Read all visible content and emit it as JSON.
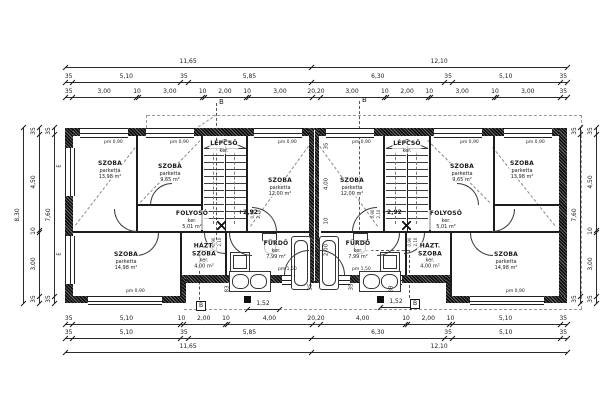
{
  "colors": {
    "ink": "#1a1a1a",
    "wall_hatch": "#0e0e0e",
    "dash": "#999999",
    "section_dash": "#555555",
    "bg": "#ffffff"
  },
  "rooms": [
    {
      "name": "SZOBA",
      "finish": "parketta",
      "area": "13,98 m²",
      "x": 110,
      "y": 170
    },
    {
      "name": "SZOBA",
      "finish": "parketta",
      "area": "9,65 m²",
      "x": 170,
      "y": 173
    },
    {
      "name": "LÉPCSŐ",
      "finish": "ker.",
      "area": "",
      "x": 224,
      "y": 147
    },
    {
      "name": "SZOBA",
      "finish": "parketta",
      "area": "12,00 m²",
      "x": 280,
      "y": 187
    },
    {
      "name": "FOLYOSÓ",
      "finish": "ker.",
      "area": "5,01 m²",
      "x": 192,
      "y": 220
    },
    {
      "name": "SZOBA",
      "finish": "parketta",
      "area": "14,98 m²",
      "x": 126,
      "y": 261
    },
    {
      "name": "HÁZT. SZOBA",
      "finish": "ker.",
      "area": "4,00 m²",
      "x": 204,
      "y": 256
    },
    {
      "name": "FÜRDŐ",
      "finish": "ker.",
      "area": "7,99 m²",
      "x": 276,
      "y": 250
    },
    {
      "name": "SZOBA",
      "finish": "parketta",
      "area": "12,00 m²",
      "x": 352,
      "y": 187
    },
    {
      "name": "LÉPCSŐ",
      "finish": "ker.",
      "area": "",
      "x": 407,
      "y": 147
    },
    {
      "name": "SZOBA",
      "finish": "parketta",
      "area": "9,65 m²",
      "x": 462,
      "y": 173
    },
    {
      "name": "SZOBA",
      "finish": "parketta",
      "area": "13,98 m²",
      "x": 522,
      "y": 170
    },
    {
      "name": "FOLYOSÓ",
      "finish": "ker.",
      "area": "5,01 m²",
      "x": 446,
      "y": 220
    },
    {
      "name": "FÜRDŐ",
      "finish": "ker.",
      "area": "7,99 m²",
      "x": 358,
      "y": 250
    },
    {
      "name": "HÁZT. SZOBA",
      "finish": "ker.",
      "area": "4,00 m²",
      "x": 430,
      "y": 256
    },
    {
      "name": "SZOBA",
      "finish": "parketta",
      "area": "14,98 m²",
      "x": 506,
      "y": 261
    }
  ],
  "dim_chains": [
    {
      "id": "top-total",
      "orient": "h",
      "x1": 65,
      "x2": 567,
      "pos": 59,
      "values": [
        "11,65",
        "12,10"
      ]
    },
    {
      "id": "top-main",
      "orient": "h",
      "x1": 65,
      "x2": 567,
      "pos": 74,
      "values": [
        "35",
        "5,10",
        "35",
        "5,85",
        "6,30",
        "35",
        "5,10",
        "35"
      ]
    },
    {
      "id": "top-detail",
      "orient": "h",
      "x1": 65,
      "x2": 567,
      "pos": 89,
      "values": [
        "35",
        "3,00",
        "10",
        "3,00",
        "10",
        "2,00",
        "10",
        "3,00",
        "20,20",
        "3,00",
        "10",
        "2,00",
        "10",
        "3,00",
        "10",
        "3,00",
        "35"
      ]
    },
    {
      "id": "bottom-detail",
      "orient": "h",
      "x1": 65,
      "x2": 567,
      "pos": 316,
      "values": [
        "35",
        "5,10",
        "10",
        "2,00",
        "10",
        "4,00",
        "20,20",
        "4,00",
        "10",
        "2,00",
        "10",
        "5,10",
        "35"
      ]
    },
    {
      "id": "bottom-main",
      "orient": "h",
      "x1": 65,
      "x2": 567,
      "pos": 330,
      "values": [
        "35",
        "5,10",
        "35",
        "5,85",
        "6,30",
        "35",
        "5,10",
        "35"
      ]
    },
    {
      "id": "bottom-total",
      "orient": "h",
      "x1": 65,
      "x2": 567,
      "pos": 344,
      "values": [
        "11,65",
        "12,10"
      ]
    },
    {
      "id": "terrace-left",
      "orient": "h",
      "x1": 247,
      "x2": 279,
      "pos": 301,
      "values": [
        "1,52"
      ]
    },
    {
      "id": "terrace-right",
      "orient": "h",
      "x1": 380,
      "x2": 412,
      "pos": 299,
      "values": [
        "1,52"
      ]
    },
    {
      "id": "left-total",
      "orient": "v",
      "y1": 127,
      "y2": 303,
      "pos": 14,
      "values": [
        "8,30"
      ]
    },
    {
      "id": "left-main",
      "orient": "v",
      "y1": 127,
      "y2": 303,
      "pos": 30,
      "values": [
        "35",
        "4,50",
        "10",
        "3,00",
        "35"
      ]
    },
    {
      "id": "left-inner",
      "orient": "v",
      "y1": 127,
      "y2": 303,
      "pos": 45,
      "values": [
        "35",
        "7,60",
        "35"
      ]
    },
    {
      "id": "right-inner",
      "orient": "v",
      "y1": 127,
      "y2": 303,
      "pos": 571,
      "values": [
        "35",
        "7,60",
        "35"
      ]
    },
    {
      "id": "right-outer",
      "orient": "v",
      "y1": 127,
      "y2": 303,
      "pos": 587,
      "values": [
        "35",
        "4,50",
        "10",
        "3,00",
        "35"
      ]
    }
  ],
  "float_labels": [
    {
      "text": "+2,92",
      "x": 238,
      "y": 210,
      "size": 6,
      "bold": true
    },
    {
      "text": "+2,92",
      "x": 382,
      "y": 210,
      "size": 6,
      "bold": true
    },
    {
      "text": "B",
      "x": 219,
      "y": 99,
      "size": 7
    },
    {
      "text": "B",
      "x": 362,
      "y": 97,
      "size": 7
    },
    {
      "text": "B",
      "x": 196,
      "y": 301,
      "size": 6,
      "boxed": true
    },
    {
      "text": "B",
      "x": 410,
      "y": 299,
      "size": 6,
      "boxed": true
    },
    {
      "text": "E",
      "x": 60,
      "y": 166,
      "size": 5,
      "rot": -90
    },
    {
      "text": "E",
      "x": 60,
      "y": 254,
      "size": 5,
      "rot": -90
    },
    {
      "text": "35",
      "x": 327,
      "y": 146,
      "size": 5.5,
      "rot": -90
    },
    {
      "text": "4,00",
      "x": 327,
      "y": 184,
      "size": 5.5,
      "rot": -90
    },
    {
      "text": "10",
      "x": 327,
      "y": 221,
      "size": 5.5,
      "rot": -90
    },
    {
      "text": "2,00",
      "x": 327,
      "y": 250,
      "size": 5.5,
      "rot": -90
    },
    {
      "text": "35",
      "x": 311,
      "y": 287,
      "size": 5.5,
      "rot": -90
    },
    {
      "text": "35",
      "x": 352,
      "y": 287,
      "size": 5.5,
      "rot": -90
    },
    {
      "text": "83",
      "x": 228,
      "y": 289,
      "size": 5.5,
      "rot": -90
    },
    {
      "text": "83",
      "x": 392,
      "y": 289,
      "size": 5.5,
      "rot": -90
    },
    {
      "text": "pm 0,90",
      "x": 104,
      "y": 141,
      "size": 4.5
    },
    {
      "text": "pm 0,90",
      "x": 170,
      "y": 141,
      "size": 4.5
    },
    {
      "text": "pm 0,90",
      "x": 278,
      "y": 141,
      "size": 4.5
    },
    {
      "text": "pm 0,90",
      "x": 352,
      "y": 141,
      "size": 4.5
    },
    {
      "text": "pm 0,90",
      "x": 460,
      "y": 141,
      "size": 4.5
    },
    {
      "text": "pm 0,90",
      "x": 526,
      "y": 141,
      "size": 4.5
    },
    {
      "text": "pm 0,90",
      "x": 126,
      "y": 290,
      "size": 4.5
    },
    {
      "text": "pm 0,90",
      "x": 506,
      "y": 290,
      "size": 4.5
    },
    {
      "text": "pm 1,50",
      "x": 278,
      "y": 268,
      "size": 4.5
    },
    {
      "text": "pm 1,50",
      "x": 352,
      "y": 268,
      "size": 4.5
    },
    {
      "text": "0,90",
      "x": 253,
      "y": 214,
      "size": 4,
      "rot": -90
    },
    {
      "text": "2,10",
      "x": 259,
      "y": 214,
      "size": 4,
      "rot": -90
    },
    {
      "text": "0,90",
      "x": 373,
      "y": 214,
      "size": 4,
      "rot": -90
    },
    {
      "text": "2,10",
      "x": 379,
      "y": 214,
      "size": 4,
      "rot": -90
    },
    {
      "text": "0,90",
      "x": 214,
      "y": 242,
      "size": 4,
      "rot": -90
    },
    {
      "text": "2,10",
      "x": 220,
      "y": 242,
      "size": 4,
      "rot": -90
    },
    {
      "text": "0,90",
      "x": 410,
      "y": 242,
      "size": 4,
      "rot": -90
    },
    {
      "text": "2,10",
      "x": 416,
      "y": 242,
      "size": 4,
      "rot": -90
    }
  ]
}
